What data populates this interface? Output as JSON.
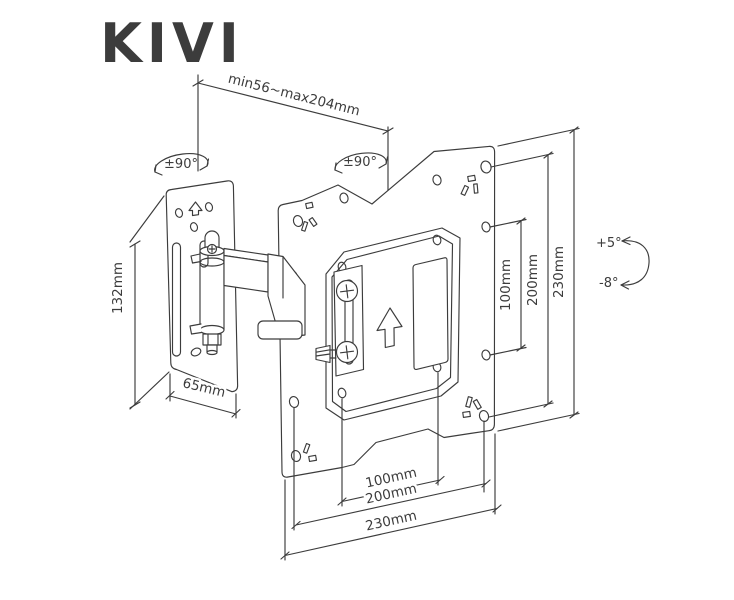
{
  "logo": {
    "text": "KIVI",
    "color": "#2e4c9e"
  },
  "drawing": {
    "type": "technical-dimension-diagram",
    "subject": "Articulating TV wall mount, isometric dimensioned drawing",
    "line_color": "#3c3c3c",
    "dimensions": {
      "arm_extension": "min56~max204mm",
      "swivel_left": "±90°",
      "swivel_right": "±90°",
      "wall_plate_height": "132mm",
      "wall_plate_width": "65mm",
      "vesa_vertical_100": "100mm",
      "vesa_vertical_200": "200mm",
      "plate_height": "230mm",
      "tilt_up": "+5°",
      "tilt_down": "-8°",
      "vesa_horizontal_100": "100mm",
      "vesa_horizontal_200": "200mm",
      "plate_width": "230mm"
    }
  }
}
